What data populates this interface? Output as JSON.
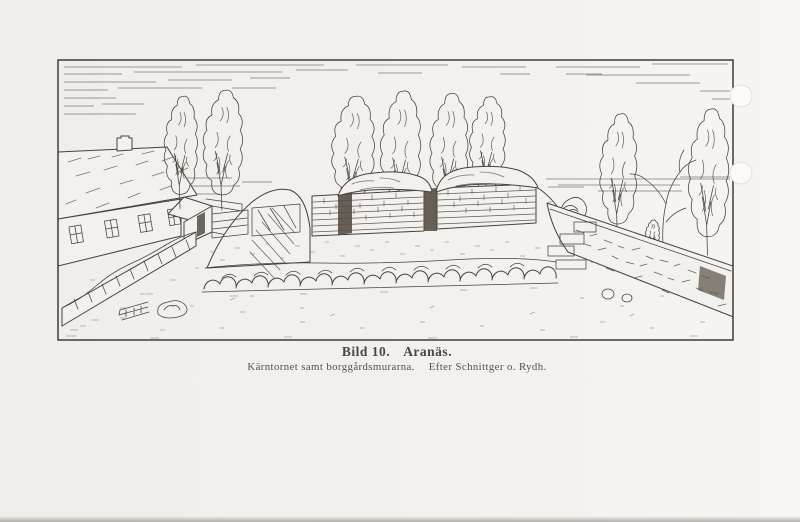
{
  "page": {
    "kind": "scanned-book-page",
    "paper_color": "#f3f1ed",
    "ink_color": "#46413b"
  },
  "figure": {
    "caption": {
      "label": "Bild 10.",
      "title": "Aranäs.",
      "description": "Kärntornet samt borggårdsmurarna.",
      "credit": "Efter Schnittger o. Rydh."
    },
    "illustration": {
      "name": "aranas-ruin-drawing",
      "description": "Pen drawing of the Aranäs ruin: grass-grown keep mound with exposed brick masonry on a boulder-walled terrace, castle-yard walls, tall poplars, and a farmhouse to the left under a lightly hatched sky."
    }
  }
}
